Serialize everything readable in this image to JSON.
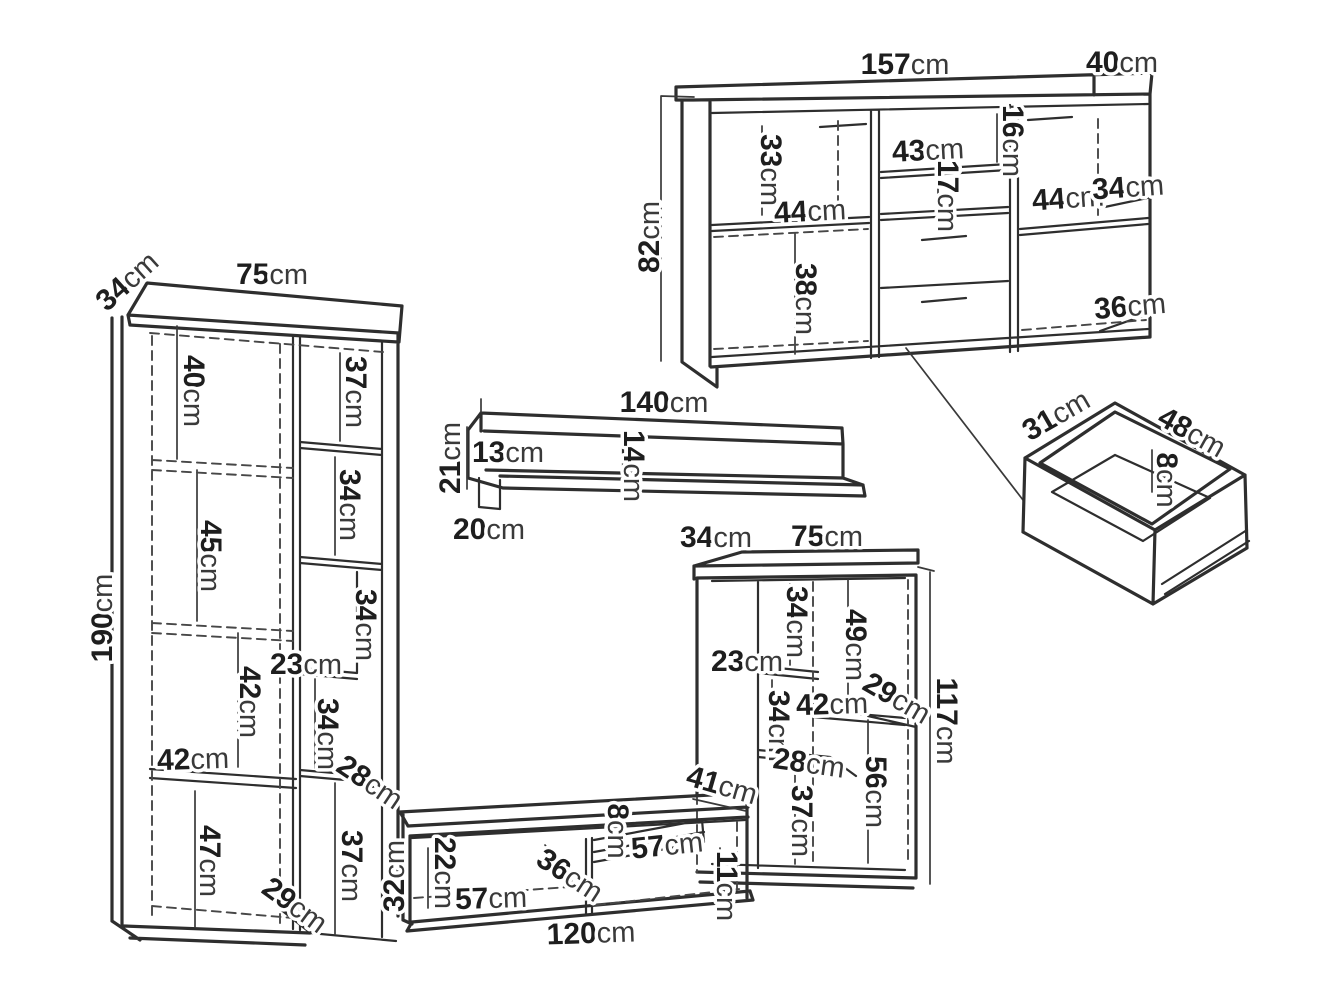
{
  "unit": "cm",
  "colors": {
    "line": "#2e2e2e",
    "text": "#1e1e1e",
    "background": "#ffffff"
  },
  "sideboard": {
    "width": "157",
    "depth": "40",
    "height": "82",
    "left_top_height": "33",
    "left_shelf_width": "44",
    "left_bottom_height": "38",
    "middle_shelf_width": "43",
    "middle_top_height": "16",
    "middle_shelf_gap": "17",
    "right_shelf_width": "44",
    "right_shelf_depth": "34",
    "right_bottom_height": "36"
  },
  "bookcase": {
    "depth": "34",
    "width": "75",
    "height": "190",
    "top_left_height": "40",
    "top_right_height": "37",
    "left_mid_height": "45",
    "right_upper_height": "34",
    "right_mid_height": "34",
    "niche_width": "23",
    "left_lower_height": "42",
    "shelf_width": "42",
    "right_lower_height": "34",
    "shelf_depth": "28",
    "bottom_left_height": "47",
    "bottom_right_height": "37",
    "base_depth": "29"
  },
  "wall_shelf": {
    "width": "140",
    "height": "21",
    "left_inner_height": "13",
    "mid_inner_height": "14",
    "bracket_depth": "20"
  },
  "display_cabinet": {
    "depth": "34",
    "width": "75",
    "height": "117",
    "upper_left_height": "34",
    "upper_right_height": "49",
    "niche_width": "23",
    "mid_left_height": "34",
    "shelf_width": "42",
    "shelf_depth": "29",
    "lower_shelf_width": "28",
    "lower_left_height": "37",
    "lower_right_height": "56"
  },
  "tv_stand": {
    "width": "120",
    "height": "32",
    "depth": "41",
    "left_opening_height": "22",
    "left_opening_width": "57",
    "left_opening_depth": "36",
    "shelf_gap_height": "8",
    "shelf_width": "57",
    "below_shelf_height": "11"
  },
  "drawer": {
    "depth": "31",
    "width": "48",
    "height": "8"
  }
}
